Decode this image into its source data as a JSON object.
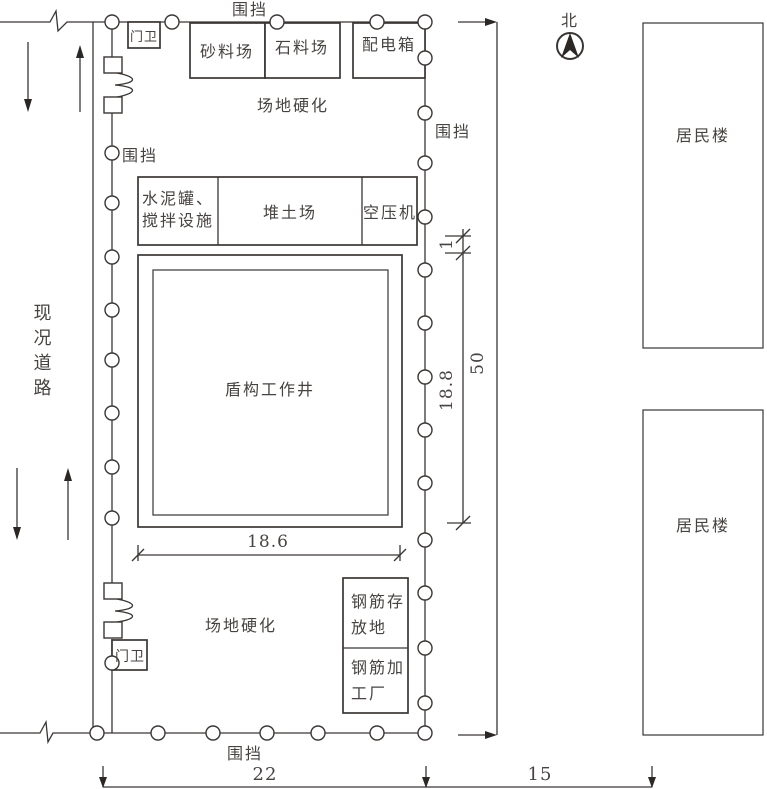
{
  "compass": {
    "north_label": "北"
  },
  "site": {
    "fence_label_top": "围挡",
    "fence_label_left": "围挡",
    "fence_label_right": "围挡",
    "fence_label_bottom": "围挡",
    "gate_guard_top": "门卫",
    "gate_guard_bottom": "门卫",
    "sand_yard": "砂料场",
    "stone_yard": "石料场",
    "power_distribution_box": "配电箱",
    "hardened_ground_top": "场地硬化",
    "hardened_ground_bottom": "场地硬化",
    "cement_mixing_line1": "水泥罐、",
    "cement_mixing_line2": "搅拌设施",
    "soil_stockpile": "堆土场",
    "air_compressor": "空压机",
    "shield_shaft": "盾构工作井",
    "rebar_storage_line1": "钢筋存",
    "rebar_storage_line2": "放地",
    "rebar_workshop_line1": "钢筋加",
    "rebar_workshop_line2": "工厂"
  },
  "surroundings": {
    "existing_road": "现况道路",
    "residential_building_top": "居民楼",
    "residential_building_bottom": "居民楼"
  },
  "dimensions": {
    "shaft_width": "18.6",
    "shaft_height": "18.8",
    "offset_gap": "1",
    "site_length": "50",
    "site_width": "22",
    "gap_to_buildings": "15"
  },
  "colors": {
    "line": "#3a3634",
    "text": "#474340"
  }
}
